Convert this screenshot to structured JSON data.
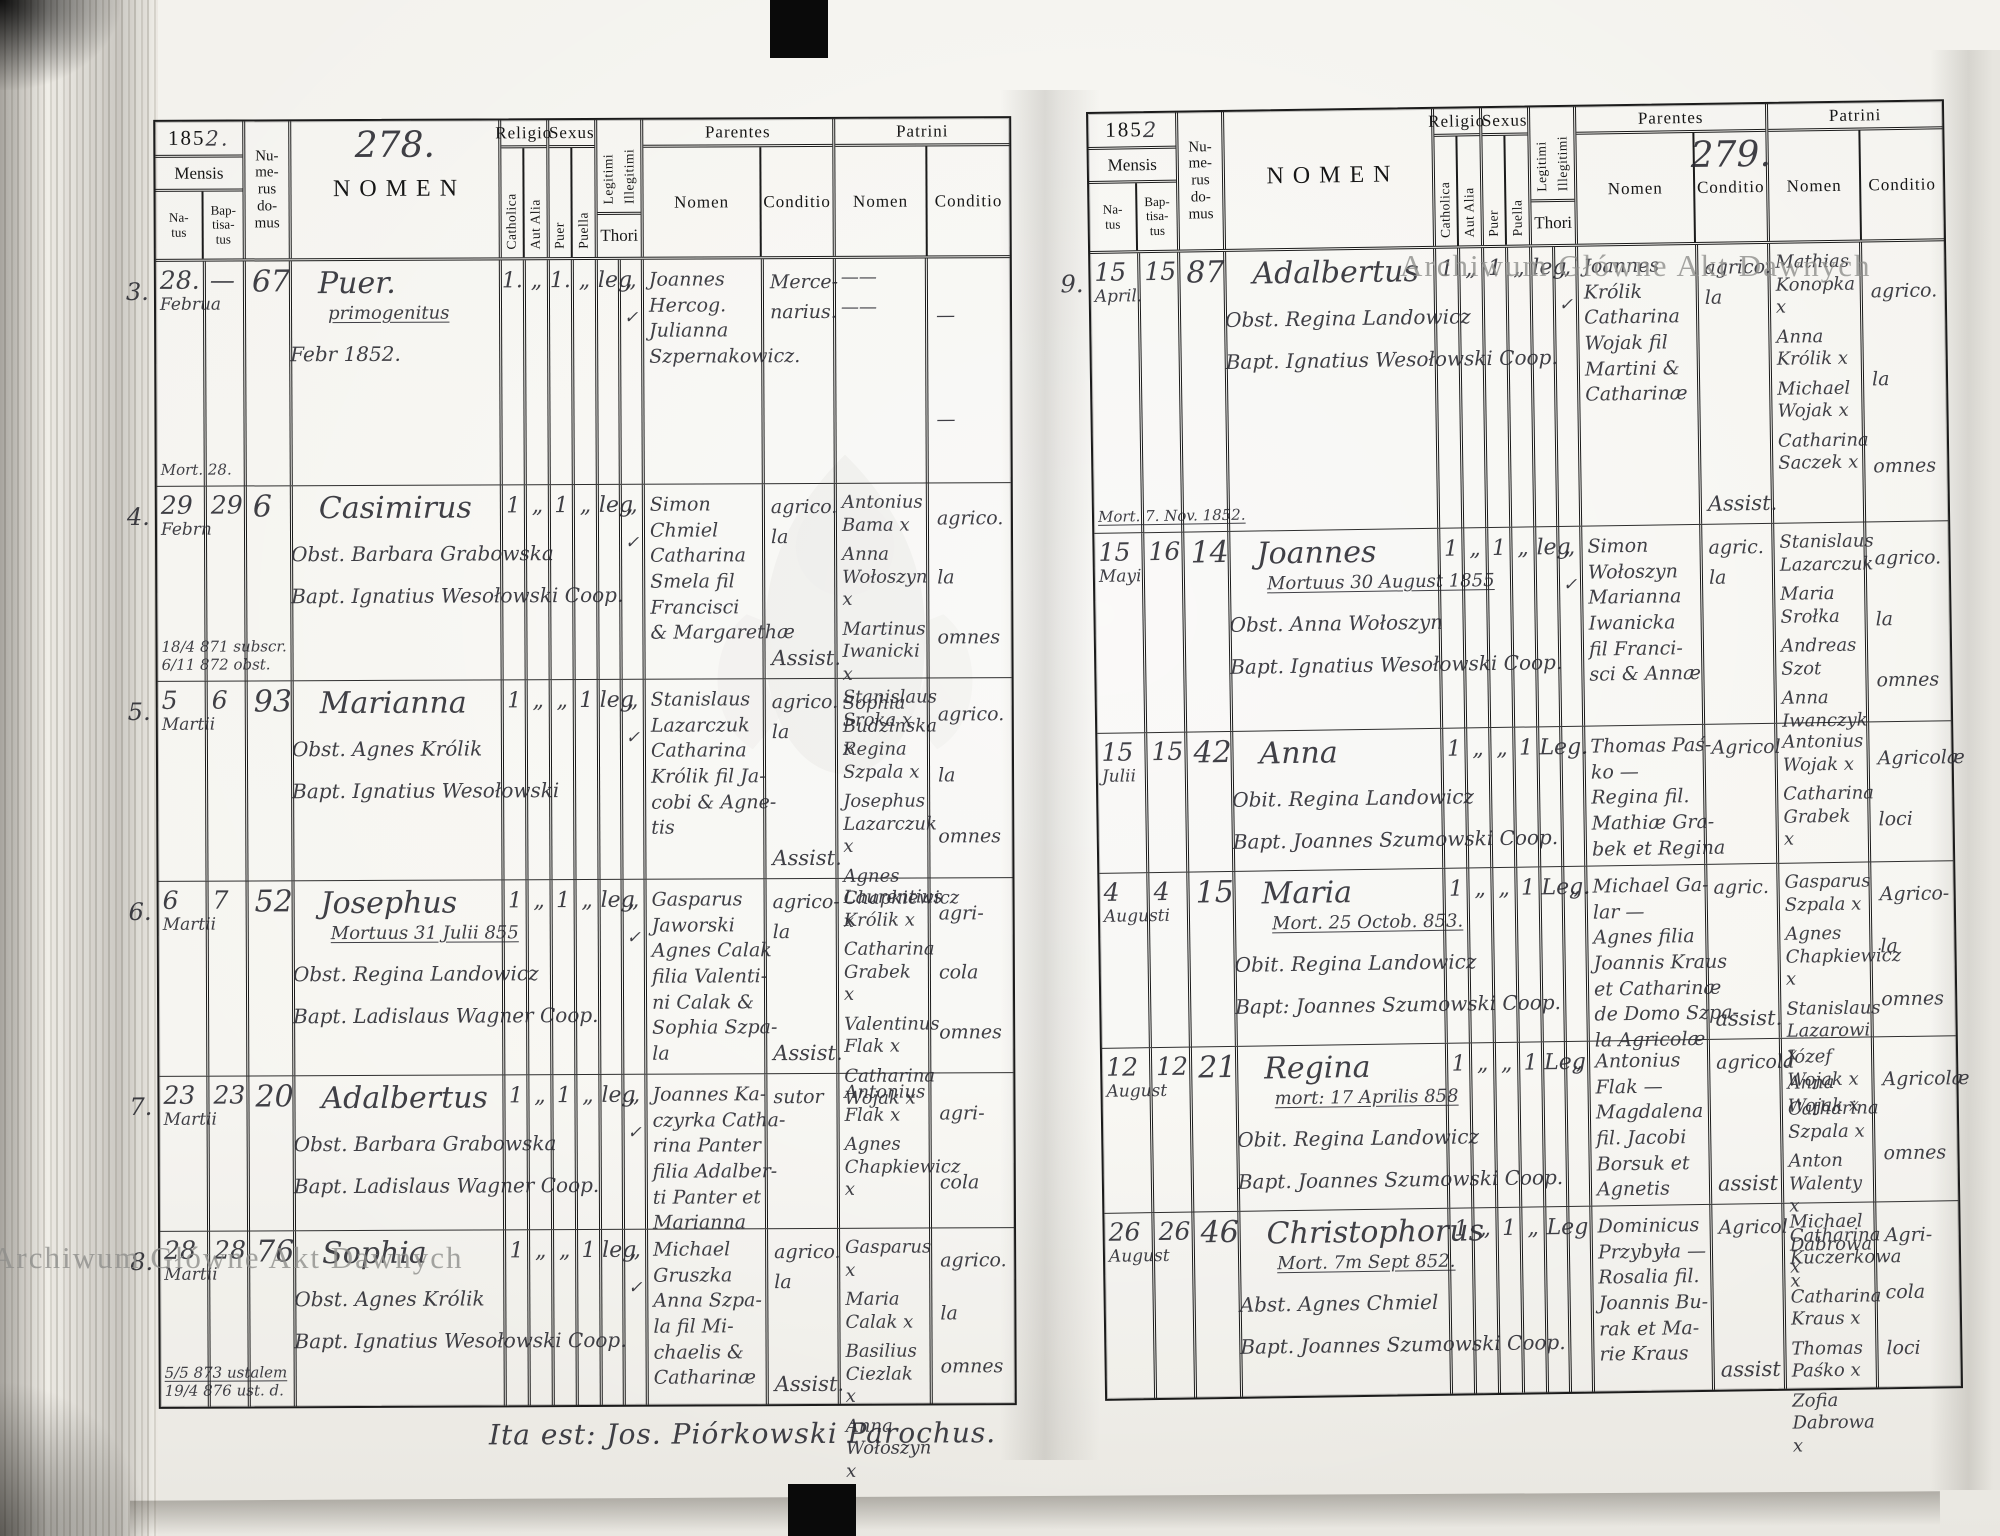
{
  "meta": {
    "year_prefix": "185",
    "year_suffix_left": "2.",
    "year_suffix_right": "2",
    "page_left": "278.",
    "page_right": "279.",
    "footer": "Ita est: Jos. Piórkowski Parochus.",
    "watermark": "Archiwum Główne Akt Dawnych"
  },
  "headers": {
    "mensis": "Mensis",
    "natus": "Na-\ntus",
    "baptisatus": "Bap-\ntisa-\ntus",
    "numerus": "Nu-\nme-\nrus\ndo-\nmus",
    "nomen": "NOMEN",
    "religio": "Religio",
    "catholica": "Catholica",
    "aut_alia": "Aut Alia",
    "sexus": "Sexus",
    "puer": "Puer",
    "puella": "Puella",
    "legitimi": "Legitimi",
    "illegitimi": "Illegitimi",
    "thori": "Thori",
    "parentes": "Parentes",
    "patrini": "Patrini",
    "sub_nomen": "Nomen",
    "sub_conditio": "Conditio"
  },
  "left_page": {
    "entries": [
      {
        "no": "3.",
        "natus": "28.",
        "mon": "Februa",
        "bapt": "—",
        "house": "67",
        "margins": [
          {
            "t": "Mort. 28.",
            "u": false
          }
        ],
        "name": "Puer.",
        "notes": [
          {
            "t": "primogenitus",
            "u": true
          },
          {
            "t": "Febr 1852.",
            "u": false
          }
        ],
        "cath": "1.",
        "alia": "„",
        "puer": "1.",
        "puella": "„",
        "leg": "leg",
        "illeg": "„",
        "check": "✓",
        "parents": [
          "Joannes",
          "Hercog.",
          "Julianna",
          "Szpernakowicz."
        ],
        "p_cond": [
          "Merce-",
          "narius."
        ],
        "assist": "",
        "patrini": [
          "——",
          "——"
        ],
        "pt_cond": [
          "—",
          "—"
        ]
      },
      {
        "no": "4.",
        "natus": "29",
        "mon": "Febrn",
        "bapt": "29",
        "house": "6",
        "margins": [
          {
            "t": "18/4 871 subscr.",
            "u": false
          },
          {
            "t": "6/11 872 obst.",
            "u": false
          }
        ],
        "name": "Casimirus",
        "notes": [
          {
            "t": "Obst. Barbara Grabowska",
            "u": false
          },
          {
            "t": "Bapt. Ignatius Wesołowski Coop.",
            "u": false
          }
        ],
        "cath": "1",
        "alia": "„",
        "puer": "1",
        "puella": "„",
        "leg": "leg",
        "illeg": "„",
        "check": "✓",
        "parents": [
          "Simon",
          "Chmiel",
          "Catharina",
          "Smela fil",
          "Francisci",
          "& Margarethæ"
        ],
        "p_cond": [
          "agrico.",
          "la"
        ],
        "assist": "Assist.",
        "patrini": [
          "Antonius Bama x",
          "Anna Wołoszyn x",
          "Martinus Iwanicki x",
          "Sophia Budzinska x"
        ],
        "pt_cond": [
          "agrico.",
          "la",
          "omnes"
        ]
      },
      {
        "no": "5.",
        "natus": "5",
        "mon": "Martii",
        "bapt": "6",
        "house": "93",
        "margins": [],
        "name": "Marianna",
        "notes": [
          {
            "t": "Obst. Agnes Królik",
            "u": false
          },
          {
            "t": "Bapt. Ignatius Wesołowski",
            "u": false
          }
        ],
        "cath": "1",
        "alia": "„",
        "puer": "„",
        "puella": "1",
        "leg": "leg",
        "illeg": "„",
        "check": "✓",
        "parents": [
          "Stanislaus",
          "Lazarczuk",
          "Catharina",
          "Królik fil Ja-",
          "cobi & Agne-",
          "tis"
        ],
        "p_cond": [
          "agrico.",
          "la"
        ],
        "assist": "Assist.",
        "patrini": [
          "Stanislaus Sroka x",
          "Regina Szpala x",
          "Josephus Lazarczuk x",
          "Agnes Chapkiewicz x"
        ],
        "pt_cond": [
          "agrico.",
          "la",
          "omnes"
        ]
      },
      {
        "no": "6.",
        "natus": "6",
        "mon": "Martii",
        "bapt": "7",
        "house": "52",
        "margins": [],
        "name": "Josephus",
        "notes": [
          {
            "t": "Mortuus 31 Julii 855",
            "u": true
          },
          {
            "t": "Obst. Regina Landowicz",
            "u": false
          },
          {
            "t": "Bapt. Ladislaus Wagner Coop.",
            "u": false
          }
        ],
        "cath": "1",
        "alia": "„",
        "puer": "1",
        "puella": "„",
        "leg": "leg",
        "illeg": "„",
        "check": "✓",
        "parents": [
          "Gasparus",
          "Jaworski",
          "Agnes Calak",
          "filia Valenti-",
          "ni Calak &",
          "Sophia Szpa-",
          "la"
        ],
        "p_cond": [
          "agrico-",
          "la"
        ],
        "assist": "Assist.",
        "patrini": [
          "Laurentius Królik x",
          "Catharina Grabek x",
          "Valentinus Flak x",
          "Catharina Wojak x"
        ],
        "pt_cond": [
          "agri-",
          "cola",
          "omnes"
        ]
      },
      {
        "no": "7.",
        "natus": "23",
        "mon": "Martii",
        "bapt": "23",
        "house": "20",
        "margins": [],
        "name": "Adalbertus",
        "notes": [
          {
            "t": "Obst. Barbara Grabowska",
            "u": false
          },
          {
            "t": "Bapt. Ladislaus Wagner Coop.",
            "u": false
          }
        ],
        "cath": "1",
        "alia": "„",
        "puer": "1",
        "puella": "„",
        "leg": "leg",
        "illeg": "„",
        "check": "✓",
        "parents": [
          "Joannes Ka-",
          "czyrka Catha-",
          "rina Panter",
          "filia Adalber-",
          "ti Panter et",
          "Marianna"
        ],
        "p_cond": [
          "sutor"
        ],
        "assist": "",
        "patrini": [
          "Antonius Flak x",
          "Agnes Chapkiewicz x"
        ],
        "pt_cond": [
          "agri-",
          "cola"
        ]
      },
      {
        "no": "8.",
        "natus": "28",
        "mon": "Martii",
        "bapt": "28",
        "house": "76",
        "margins": [
          {
            "t": "5/5 873 ustalem",
            "u": true
          },
          {
            "t": "19/4 876 ust. d.",
            "u": false
          }
        ],
        "name": "Sophia",
        "notes": [
          {
            "t": "Obst. Agnes Królik",
            "u": false
          },
          {
            "t": "Bapt. Ignatius Wesołowski Coop.",
            "u": false
          }
        ],
        "cath": "1",
        "alia": "„",
        "puer": "„",
        "puella": "1",
        "leg": "leg",
        "illeg": "„",
        "check": "✓",
        "parents": [
          "Michael",
          "Gruszka",
          "Anna Szpa-",
          "la fil Mi-",
          "chaelis &",
          "Catharinæ"
        ],
        "p_cond": [
          "agrico.",
          "la"
        ],
        "assist": "Assist.",
        "patrini": [
          "Gasparus x",
          "Maria Calak x",
          "Basilius Ciezlak x",
          "Anna Wołoszyn x"
        ],
        "pt_cond": [
          "agrico.",
          "la",
          "omnes"
        ]
      }
    ]
  },
  "right_page": {
    "entries": [
      {
        "no": "9.",
        "natus": "15",
        "mon": "April.",
        "bapt": "15",
        "house": "87",
        "margins": [
          {
            "t": "Mort. 7. Nov. 1852.",
            "u": true
          }
        ],
        "name": "Adalbertus",
        "notes": [
          {
            "t": "Obst. Regina Landowicz",
            "u": false
          },
          {
            "t": "Bapt. Ignatius Wesołowski Coop.",
            "u": false
          }
        ],
        "cath": "1",
        "alia": "„",
        "puer": "1",
        "puella": "„",
        "leg": "leg",
        "illeg": "„",
        "check": "✓",
        "parents": [
          "Joannes",
          "Królik",
          "Catharina",
          "Wojak fil",
          "Martini &",
          "Catharinæ"
        ],
        "p_cond": [
          "agrico.",
          "la"
        ],
        "assist": "Assist.",
        "patrini": [
          "Mathias Konopka x",
          "Anna Królik x",
          "Michael Wojak x",
          "Catharina Saczek x"
        ],
        "pt_cond": [
          "agrico.",
          "la",
          "omnes"
        ]
      },
      {
        "no": "",
        "natus": "15",
        "mon": "Mayi",
        "bapt": "16",
        "house": "14",
        "margins": [],
        "name": "Joannes",
        "notes": [
          {
            "t": "Mortuus 30 August 1855",
            "u": true
          },
          {
            "t": "Obst. Anna Wołoszyn",
            "u": false
          },
          {
            "t": "Bapt. Ignatius Wesołowski Coop.",
            "u": false
          }
        ],
        "cath": "1",
        "alia": "„",
        "puer": "1",
        "puella": "„",
        "leg": "leg",
        "illeg": "„",
        "check": "✓",
        "parents": [
          "Simon",
          "Wołoszyn",
          "Marianna",
          "Iwanicka",
          "fil Franci-",
          "sci & Annæ"
        ],
        "p_cond": [
          "agric.",
          "la"
        ],
        "assist": "",
        "patrini": [
          "Stanislaus Lazarczuk",
          "Maria Srołka",
          "Andreas Szot",
          "Anna Iwanczyk"
        ],
        "pt_cond": [
          "agrico.",
          "la",
          "omnes"
        ]
      },
      {
        "no": "",
        "natus": "15",
        "mon": "Julii",
        "bapt": "15",
        "house": "42",
        "margins": [],
        "name": "Anna",
        "notes": [
          {
            "t": "Obit. Regina Landowicz",
            "u": false
          },
          {
            "t": "Bapt. Joannes Szumowski Coop.",
            "u": false
          }
        ],
        "cath": "1",
        "alia": "„",
        "puer": "„",
        "puella": "1",
        "leg": "Leg.",
        "illeg": "",
        "check": "",
        "parents": [
          "Thomas Paś-",
          "ko —",
          "Regina fil.",
          "Mathiæ Gra-",
          "bek et Regina"
        ],
        "p_cond": [
          "Agricol"
        ],
        "assist": "",
        "patrini": [
          "Antonius Wojak x",
          "Catharina Grabek x"
        ],
        "pt_cond": [
          "Agricolæ",
          "loci"
        ]
      },
      {
        "no": "",
        "natus": "4",
        "mon": "Augusti",
        "bapt": "4",
        "house": "15",
        "margins": [],
        "name": "Maria",
        "notes": [
          {
            "t": "Mort. 25 Octob. 853.",
            "u": true
          },
          {
            "t": "Obit. Regina Landowicz",
            "u": false
          },
          {
            "t": "Bapt: Joannes Szumowski Coop.",
            "u": false
          }
        ],
        "cath": "1",
        "alia": "„",
        "puer": "„",
        "puella": "1",
        "leg": "Leg.",
        "illeg": "„",
        "check": "",
        "parents": [
          "Michael Ga-",
          "lar —",
          "Agnes filia",
          "Joannis Kraus",
          "et Catharinæ",
          "de Domo Szpa-",
          "la Agricolæ"
        ],
        "p_cond": [
          "agric."
        ],
        "assist": "assist.",
        "patrini": [
          "Gasparus Szpala x",
          "Agnes Chapkiewicz x",
          "Stanislaus Lazarowi x",
          "Anna Wojak x"
        ],
        "pt_cond": [
          "Agrico-",
          "la",
          "omnes"
        ]
      },
      {
        "no": "",
        "natus": "12",
        "mon": "August",
        "bapt": "12",
        "house": "21",
        "margins": [],
        "name": "Regina",
        "notes": [
          {
            "t": "mort: 17 Aprilis 858",
            "u": true
          },
          {
            "t": "Obit. Regina Landowicz",
            "u": false
          },
          {
            "t": "Bapt. Joannes Szumowski Coop.",
            "u": false
          }
        ],
        "cath": "1",
        "alia": "„",
        "puer": "„",
        "puella": "1",
        "leg": "Leg",
        "illeg": "„",
        "check": "",
        "parents": [
          "Antonius",
          "Flak —",
          "Magdalena",
          "fil. Jacobi",
          "Borsuk et",
          "Agnetis"
        ],
        "p_cond": [
          "agricola"
        ],
        "assist": "assist",
        "patrini": [
          "Józef Wojak x",
          "Catharina Szpala x",
          "Anton Walenty x",
          "Catharina Kuczerkowa x"
        ],
        "pt_cond": [
          "Agricolæ",
          "omnes"
        ]
      },
      {
        "no": "",
        "natus": "26",
        "mon": "August",
        "bapt": "26",
        "house": "46",
        "margins": [],
        "name": "Christophorus",
        "notes": [
          {
            "t": "Mort. 7m Sept 852.",
            "u": true
          },
          {
            "t": "Abst. Agnes Chmiel",
            "u": false
          },
          {
            "t": "Bapt. Joannes Szumowski Coop.",
            "u": false
          }
        ],
        "cath": "1",
        "alia": "„",
        "puer": "1",
        "puella": "„",
        "leg": "Leg",
        "illeg": "",
        "check": "",
        "parents": [
          "Dominicus",
          "Przybyła —",
          "Rosalia fil.",
          "Joannis Bu-",
          "rak et Ma-",
          "rie Kraus"
        ],
        "p_cond": [
          "Agricol"
        ],
        "assist": "assist",
        "patrini": [
          "Michael Dabrowa x",
          "Catharina Kraus x",
          "Thomas Paśko x",
          "Zofia Dabrowa x"
        ],
        "pt_cond": [
          "Agri-",
          "cola",
          "loci"
        ]
      }
    ]
  }
}
